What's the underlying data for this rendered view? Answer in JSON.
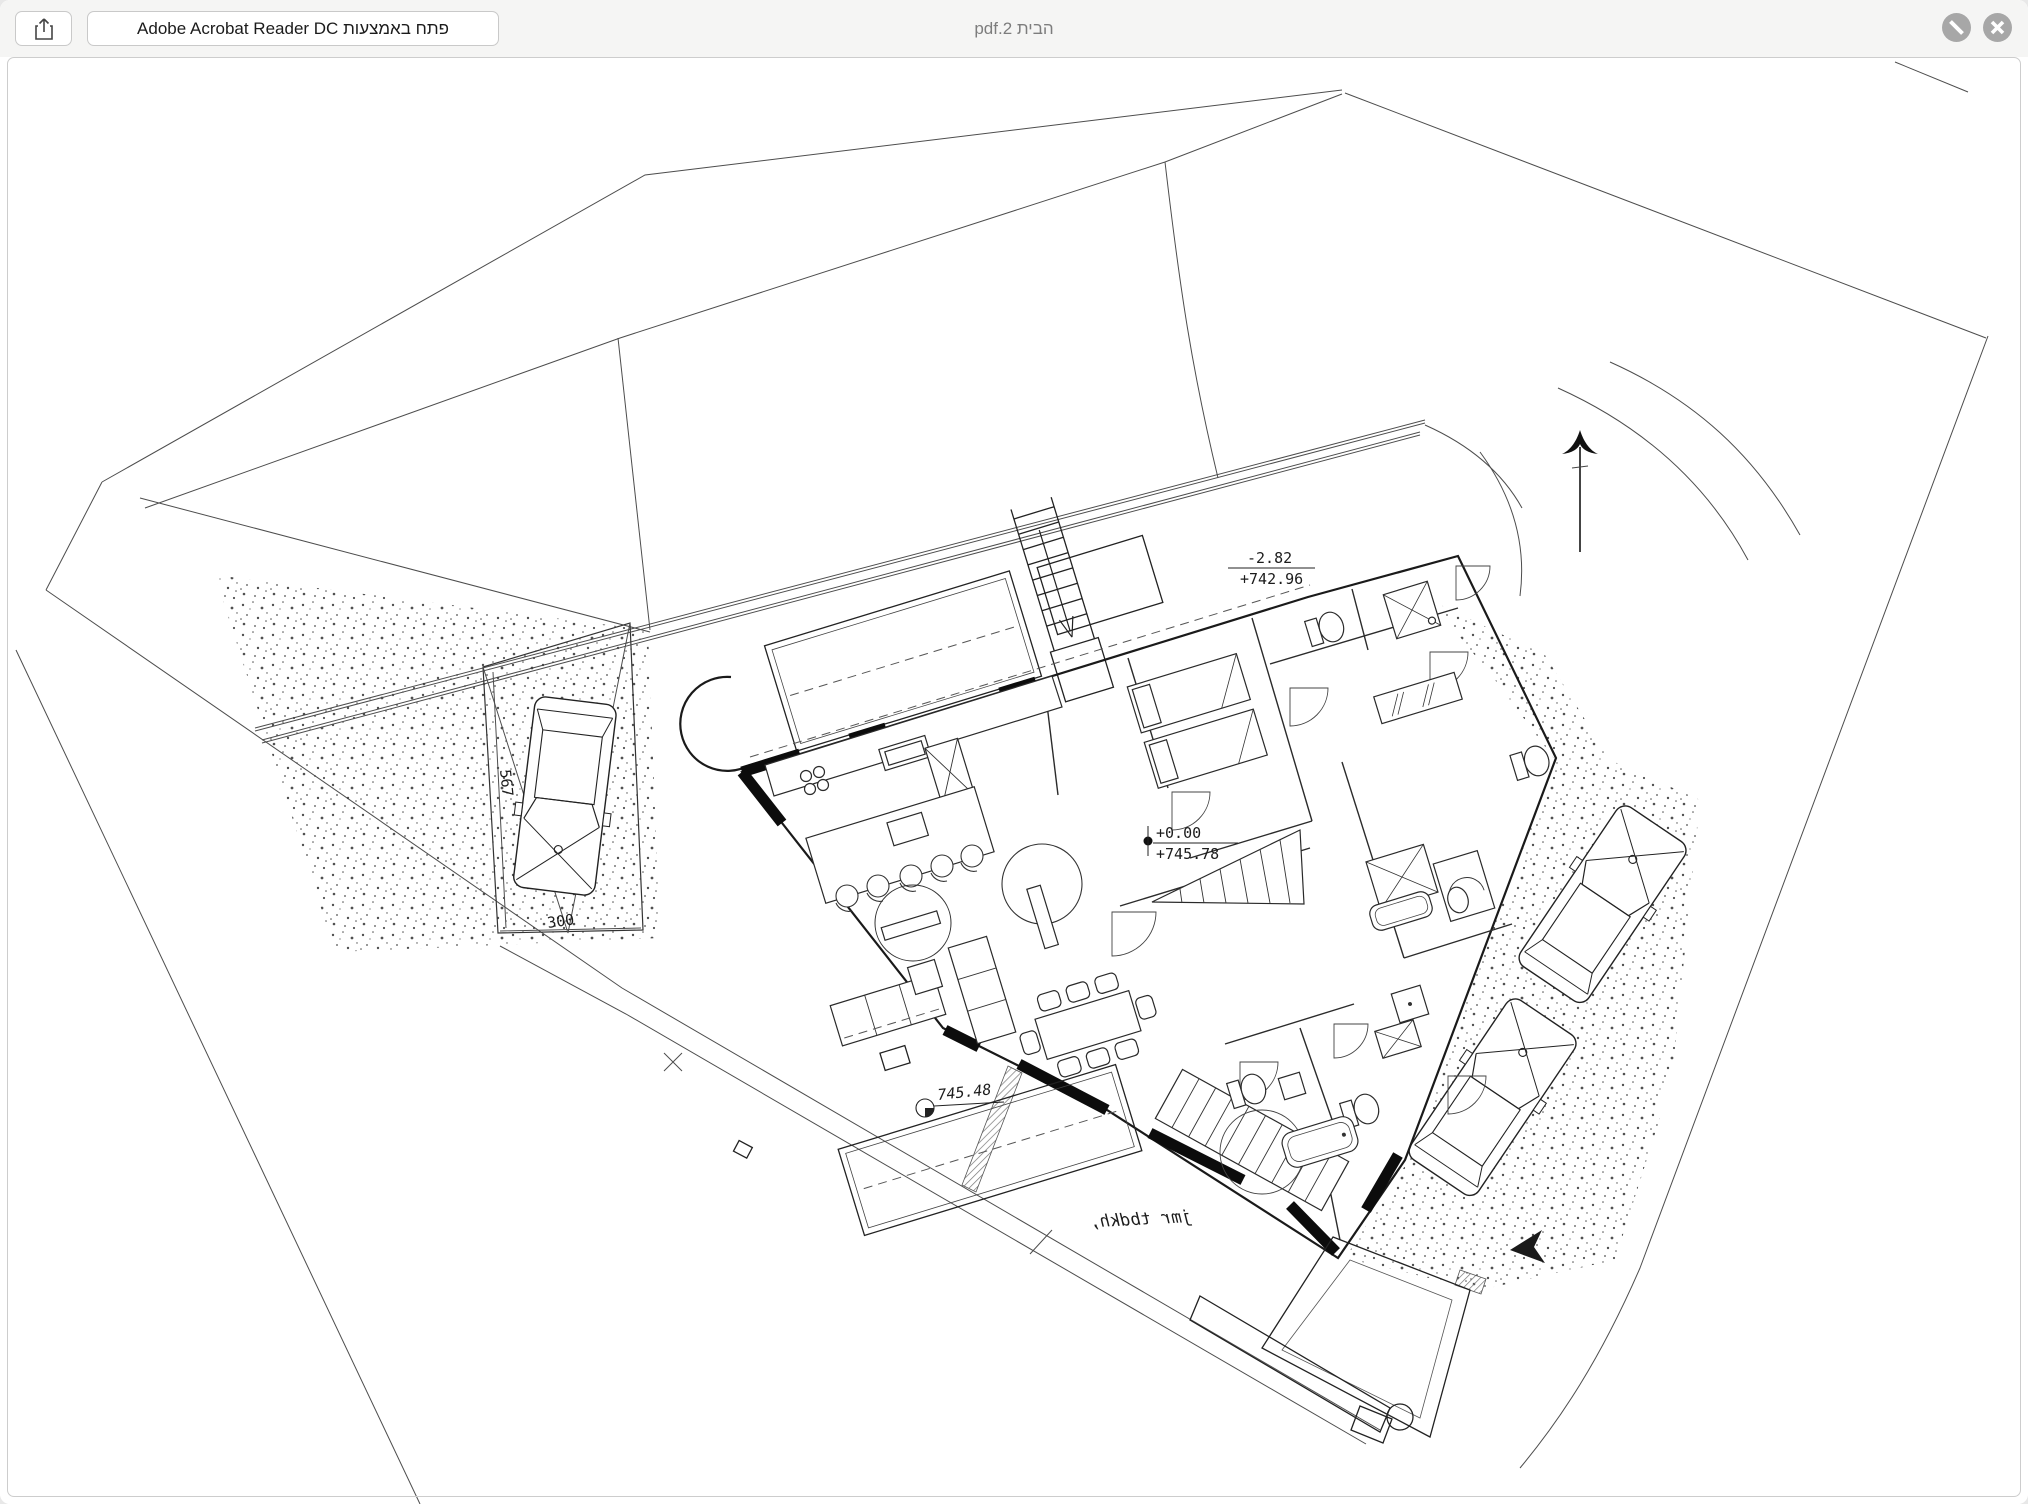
{
  "titlebar": {
    "title": "pdf.2 הבית",
    "open_with_label": "Adobe Acrobat Reader DC פתח באמצעות",
    "icons": {
      "share": "share-icon",
      "markup": "slash-circle-icon",
      "close": "close-circle-icon"
    }
  },
  "annotations": {
    "street_level": {
      "delta": "-2.82",
      "elevation": "+742.96"
    },
    "entry_level": {
      "delta": "+0.00",
      "elevation": "+745.78"
    },
    "spot_level": "745.48",
    "parking": {
      "length": "567",
      "width": "300"
    },
    "mirrored_note": "jmr tbdkh,"
  },
  "drawing_icons": {
    "north": "north-arrow-icon",
    "entrance": "entrance-arrow-icon",
    "benchmark": "level-marker-icon"
  },
  "colors": {
    "titlebar_bg": "#f5f5f4",
    "button_border": "#c9c9c9",
    "title_text": "#7d7d7d",
    "control_gray": "#a7a7a7",
    "line_black": "#1a1a1a",
    "frame_border": "#cdcdcd"
  }
}
